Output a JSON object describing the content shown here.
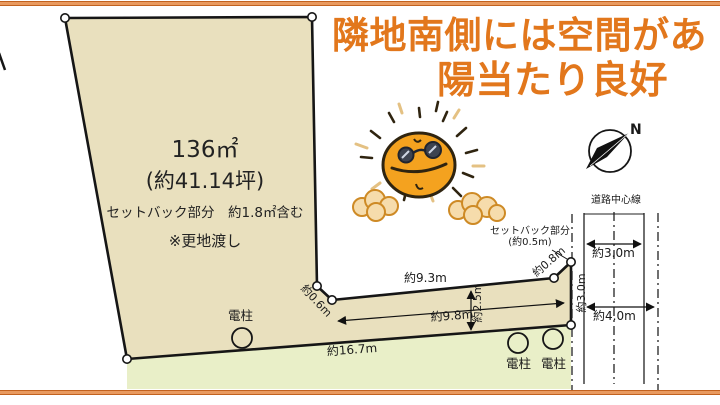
{
  "headline": {
    "line1": "隣地南側には空間があ",
    "line2": "陽当たり良好"
  },
  "parcel": {
    "area": "136㎡",
    "tsubo": "(約41.14坪)",
    "setback_included": "セットバック部分　約1.8㎡含む",
    "condition": "※更地渡し"
  },
  "dimensions": {
    "strip_top": "約9.3m",
    "notch_edge": "約0.6m",
    "setback_edge": "約0.8m",
    "right_edge": "約3.0m",
    "strip_width": "約2.5m",
    "strip_length": "約9.8m",
    "bottom_edge": "約16.7m"
  },
  "setback_callout": {
    "line1": "セットバック部分",
    "line2": "(約0.5m)"
  },
  "road": {
    "centerline": "道路中心線",
    "width_current": "約3.0m",
    "width_planned": "約4.0m"
  },
  "poles": {
    "left": "電柱",
    "middle": "電柱",
    "right": "電柱"
  },
  "compass": {
    "north": "N"
  },
  "colors": {
    "headline_orange": "#E2771C",
    "parcel_fill": "#E9E0BE",
    "green_fill": "#E9EFC8",
    "border_band": "#E99A5F",
    "band_edge": "#C2621F",
    "sun_orange": "#F4A21F",
    "cloud_tan": "#F6DCAC"
  }
}
